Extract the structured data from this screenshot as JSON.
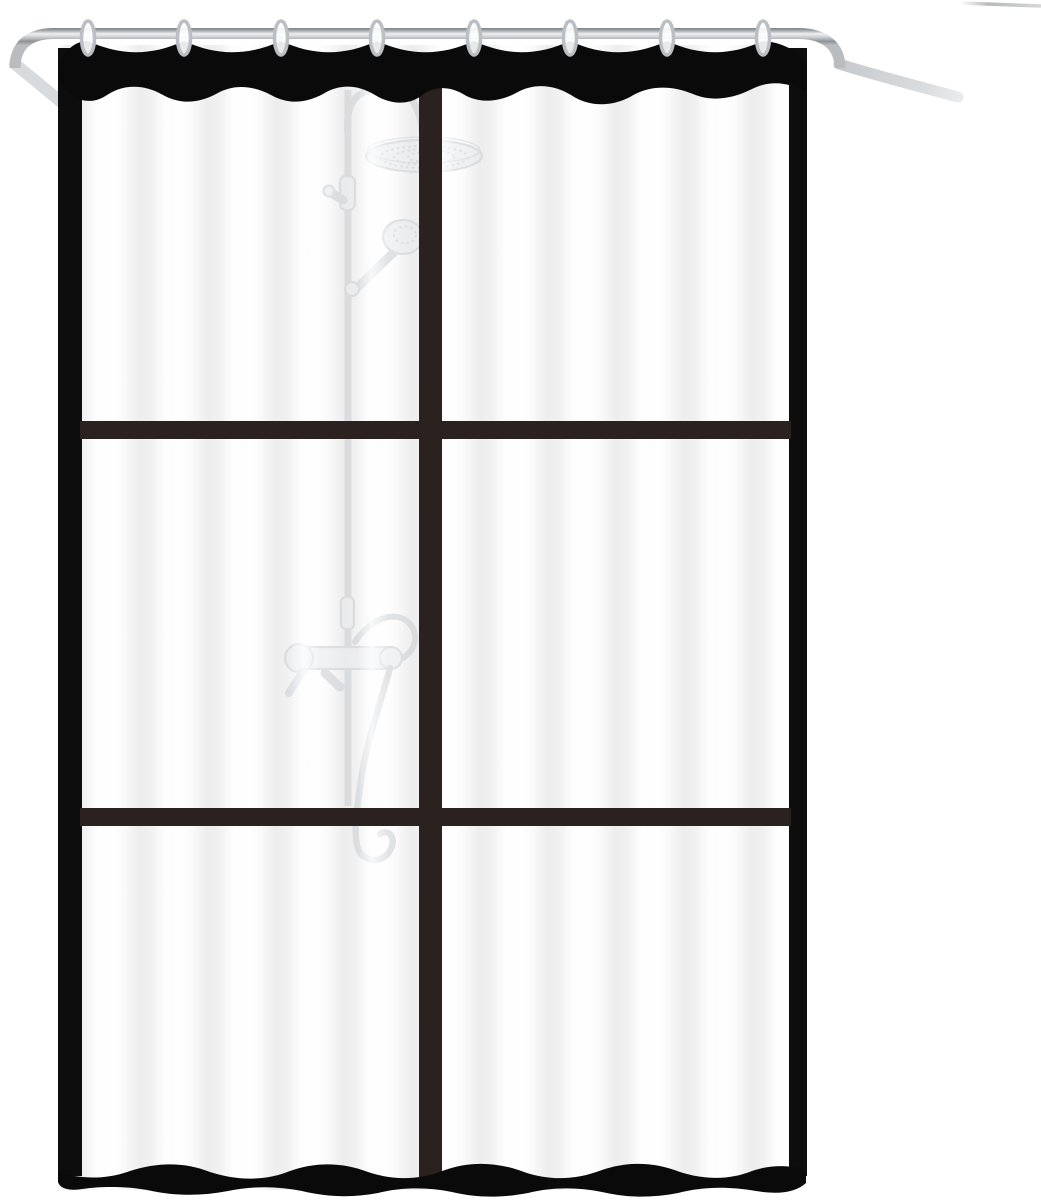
{
  "scene": {
    "type": "product-photo",
    "subject": "Translucent shower curtain with black window-pane grid hanging by rings on a curved chrome rod; faint shower fixture silhouette behind the fabric",
    "colors": {
      "background": "#ffffff",
      "band": "#0a0a0a",
      "frameBorder": "#0e0d0d",
      "innerBar": "#2b211e",
      "hook": "#b9bfc4",
      "returnTube": "#d8dbdd",
      "fixtureLine": "#c9ced3",
      "fixtureFill": "#e7eaec"
    },
    "curtain": {
      "grid_columns": 2,
      "grid_rows": 3,
      "pane_count": 6
    },
    "hooks": {
      "count": 8,
      "positions_x": [
        88,
        184,
        281,
        377,
        474,
        570,
        667,
        763
      ]
    }
  }
}
